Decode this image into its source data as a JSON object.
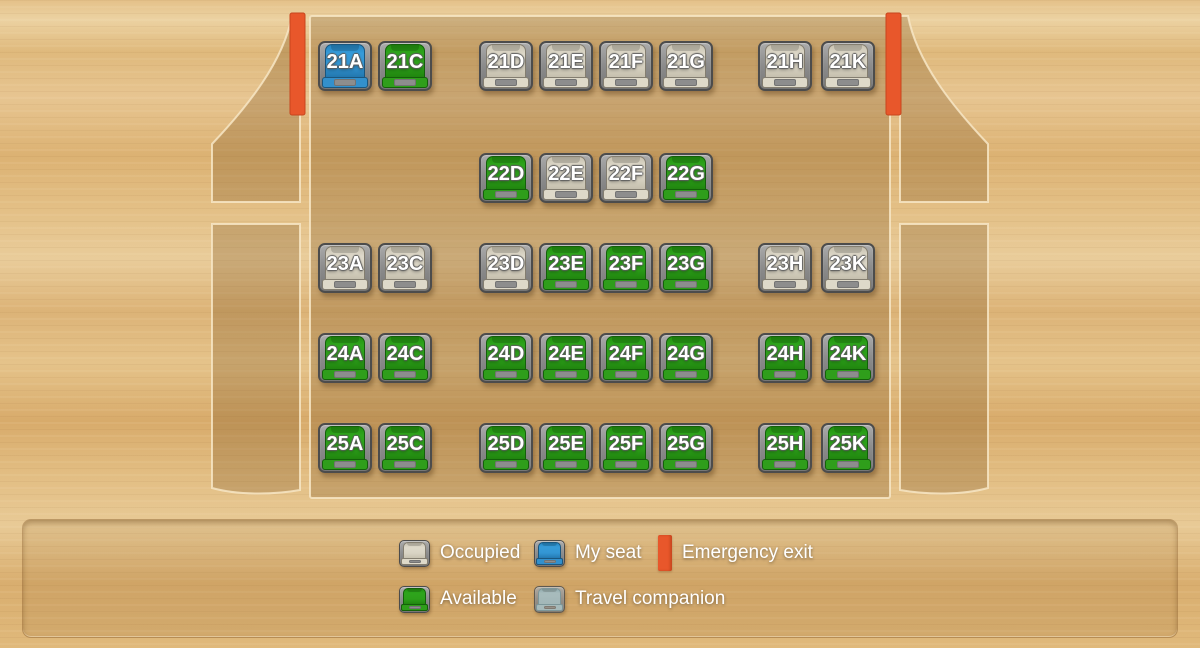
{
  "legend": {
    "occupied": "Occupied",
    "my_seat": "My seat",
    "emergency_exit": "Emergency exit",
    "available": "Available",
    "travel_companion": "Travel companion"
  },
  "colors": {
    "available": "#2da01a",
    "occupied": "#d9d4c4",
    "my_seat": "#3396d4",
    "travel_companion": "#9bbac6",
    "emergency_exit": "#e8572b",
    "seat_frame": "#8e8e8e",
    "wood_background": "#deb57a"
  },
  "seat_map": {
    "rows": [
      {
        "row": "21",
        "seats": [
          {
            "id": "21A",
            "letter": "A",
            "status": "myseat"
          },
          {
            "id": "21C",
            "letter": "C",
            "status": "available"
          },
          {
            "id": "21D",
            "letter": "D",
            "status": "occupied"
          },
          {
            "id": "21E",
            "letter": "E",
            "status": "occupied"
          },
          {
            "id": "21F",
            "letter": "F",
            "status": "occupied"
          },
          {
            "id": "21G",
            "letter": "G",
            "status": "occupied"
          },
          {
            "id": "21H",
            "letter": "H",
            "status": "occupied"
          },
          {
            "id": "21K",
            "letter": "K",
            "status": "occupied"
          }
        ]
      },
      {
        "row": "22",
        "seats": [
          {
            "id": "22D",
            "letter": "D",
            "status": "available"
          },
          {
            "id": "22E",
            "letter": "E",
            "status": "occupied"
          },
          {
            "id": "22F",
            "letter": "F",
            "status": "occupied"
          },
          {
            "id": "22G",
            "letter": "G",
            "status": "available"
          }
        ]
      },
      {
        "row": "23",
        "seats": [
          {
            "id": "23A",
            "letter": "A",
            "status": "occupied"
          },
          {
            "id": "23C",
            "letter": "C",
            "status": "occupied"
          },
          {
            "id": "23D",
            "letter": "D",
            "status": "occupied"
          },
          {
            "id": "23E",
            "letter": "E",
            "status": "available"
          },
          {
            "id": "23F",
            "letter": "F",
            "status": "available"
          },
          {
            "id": "23G",
            "letter": "G",
            "status": "available"
          },
          {
            "id": "23H",
            "letter": "H",
            "status": "occupied"
          },
          {
            "id": "23K",
            "letter": "K",
            "status": "occupied"
          }
        ]
      },
      {
        "row": "24",
        "seats": [
          {
            "id": "24A",
            "letter": "A",
            "status": "available"
          },
          {
            "id": "24C",
            "letter": "C",
            "status": "available"
          },
          {
            "id": "24D",
            "letter": "D",
            "status": "available"
          },
          {
            "id": "24E",
            "letter": "E",
            "status": "available"
          },
          {
            "id": "24F",
            "letter": "F",
            "status": "available"
          },
          {
            "id": "24G",
            "letter": "G",
            "status": "available"
          },
          {
            "id": "24H",
            "letter": "H",
            "status": "available"
          },
          {
            "id": "24K",
            "letter": "K",
            "status": "available"
          }
        ]
      },
      {
        "row": "25",
        "seats": [
          {
            "id": "25A",
            "letter": "A",
            "status": "available"
          },
          {
            "id": "25C",
            "letter": "C",
            "status": "available"
          },
          {
            "id": "25D",
            "letter": "D",
            "status": "available"
          },
          {
            "id": "25E",
            "letter": "E",
            "status": "available"
          },
          {
            "id": "25F",
            "letter": "F",
            "status": "available"
          },
          {
            "id": "25G",
            "letter": "G",
            "status": "available"
          },
          {
            "id": "25H",
            "letter": "H",
            "status": "available"
          },
          {
            "id": "25K",
            "letter": "K",
            "status": "available"
          }
        ]
      }
    ]
  }
}
